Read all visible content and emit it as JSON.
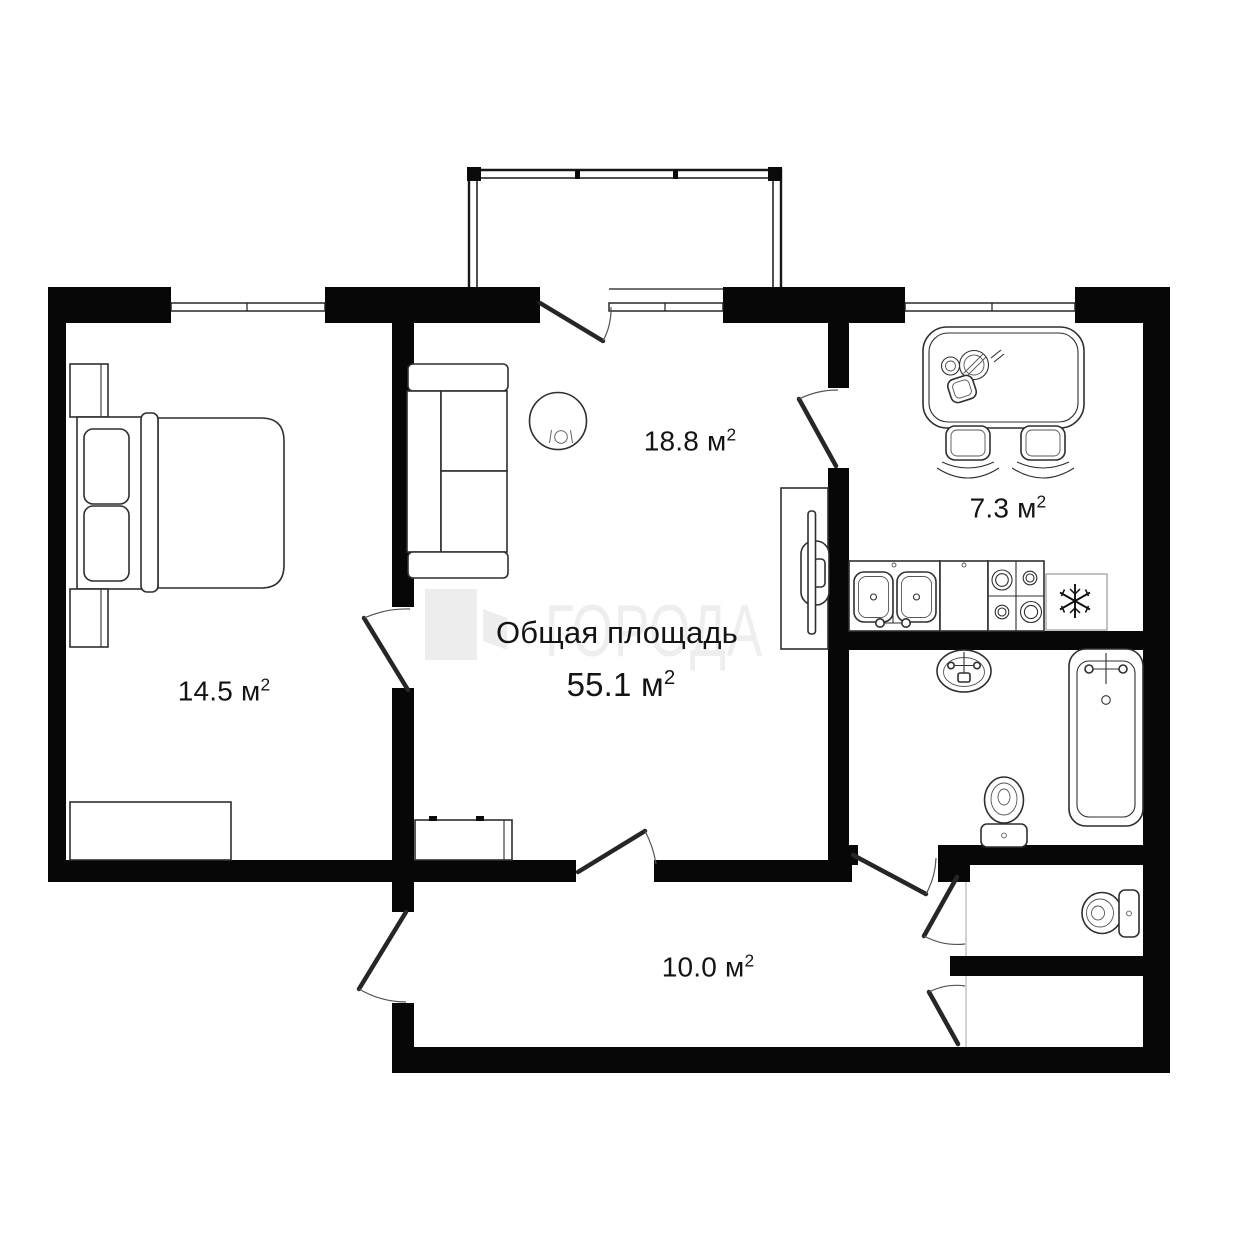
{
  "watermark": {
    "text": "ГОРОДА"
  },
  "summary": {
    "title": "Общая площадь",
    "area": "55.1 м",
    "area_sup": "2"
  },
  "rooms": {
    "bedroom": {
      "area": "14.5 м",
      "area_sup": "2"
    },
    "living_room": {
      "area": "18.8 м",
      "area_sup": "2"
    },
    "kitchen": {
      "area": "7.3 м",
      "area_sup": "2"
    },
    "hallway": {
      "area": "10.0 м",
      "area_sup": "2"
    }
  },
  "fixtures": [
    "balcony",
    "bed",
    "pillow",
    "nightstand",
    "dresser",
    "sofa",
    "round-table",
    "tv-stand",
    "dining-table",
    "chair",
    "kitchen-double-sink",
    "stove",
    "refrigerator-snowflake",
    "washbasin",
    "bathtub",
    "toilet",
    "wc-toilet",
    "window",
    "door-swing"
  ],
  "colors": {
    "walls": "#070707",
    "furniture_lines": "#2f2f2f",
    "light_lines": "#9a9a9a",
    "watermark": "#ededed",
    "text": "#141414",
    "background": "#ffffff"
  }
}
